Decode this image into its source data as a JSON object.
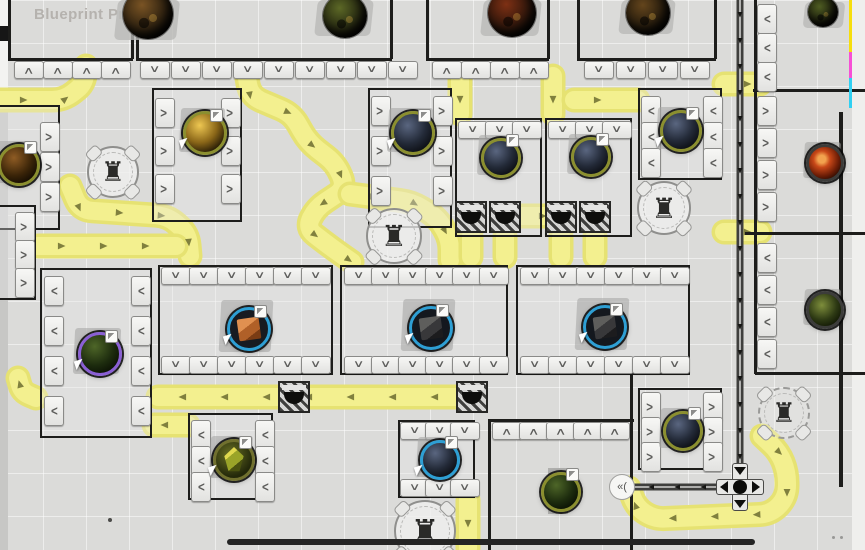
{
  "header": {
    "title": "Blueprint Preview"
  },
  "colors": {
    "background": "#dbdbd9",
    "belt": "#f3f08f",
    "belt_edge": "#e6e272",
    "belt_arrow": "#80803e",
    "wall": "#1d1d1b",
    "rail": "#3f3f3d",
    "module_fill": "#f1f1ef",
    "accent_blue": "#2e9fd4",
    "accent_olive": "#8b8f2f",
    "strip_yellow": "#f6de0c",
    "strip_magenta": "#f750d6",
    "strip_cyan": "#30d0f2",
    "title_text": "#b5b2ae"
  },
  "scene": {
    "belts": [
      {
        "points": [
          [
            0,
            100
          ],
          [
            64,
            100
          ],
          [
            84,
            84
          ],
          [
            86,
            66
          ]
        ]
      },
      {
        "points": [
          [
            246,
            72
          ],
          [
            250,
            96
          ],
          [
            292,
            114
          ],
          [
            308,
            142
          ],
          [
            336,
            164
          ],
          [
            346,
            188
          ],
          [
            316,
            208
          ],
          [
            306,
            228
          ],
          [
            332,
            248
          ],
          [
            352,
            262
          ]
        ]
      },
      {
        "points": [
          [
            350,
            194
          ],
          [
            412,
            202
          ],
          [
            438,
            218
          ],
          [
            450,
            240
          ],
          [
            450,
            260
          ]
        ]
      },
      {
        "points": [
          [
            70,
            186
          ],
          [
            80,
            210
          ],
          [
            168,
            216
          ],
          [
            188,
            234
          ],
          [
            190,
            256
          ]
        ]
      },
      {
        "points": [
          [
            38,
            246
          ],
          [
            176,
            246
          ]
        ]
      },
      {
        "points": [
          [
            460,
            76
          ],
          [
            460,
            114
          ]
        ]
      },
      {
        "points": [
          [
            553,
            76
          ],
          [
            553,
            114
          ]
        ]
      },
      {
        "points": [
          [
            574,
            100
          ],
          [
            638,
            100
          ]
        ]
      },
      {
        "points": [
          [
            519,
            216
          ],
          [
            547,
            216
          ]
        ]
      },
      {
        "points": [
          [
            471,
            236
          ],
          [
            471,
            257
          ]
        ]
      },
      {
        "points": [
          [
            505,
            236
          ],
          [
            505,
            257
          ]
        ]
      },
      {
        "points": [
          [
            561,
            236
          ],
          [
            561,
            257
          ]
        ]
      },
      {
        "points": [
          [
            595,
            236
          ],
          [
            595,
            257
          ]
        ]
      },
      {
        "points": [
          [
            724,
            84
          ],
          [
            760,
            84
          ]
        ]
      },
      {
        "points": [
          [
            724,
            232
          ],
          [
            760,
            232
          ]
        ]
      },
      {
        "points": [
          [
            458,
            397
          ],
          [
            158,
            397
          ]
        ]
      },
      {
        "points": [
          [
            36,
            398
          ],
          [
            22,
            392
          ],
          [
            18,
            378
          ]
        ]
      },
      {
        "points": [
          [
            188,
            425
          ],
          [
            154,
            425
          ]
        ]
      },
      {
        "points": [
          [
            468,
            500
          ],
          [
            468,
            548
          ]
        ]
      },
      {
        "points": [
          [
            762,
            436
          ],
          [
            779,
            452
          ],
          [
            787,
            472
          ],
          [
            787,
            497
          ],
          [
            771,
            514
          ],
          [
            654,
            519
          ],
          [
            636,
            507
          ],
          [
            629,
            488
          ]
        ]
      }
    ],
    "rails": [
      {
        "points": [
          [
            740,
            0
          ],
          [
            740,
            464
          ]
        ]
      },
      {
        "points": [
          [
            718,
            487
          ],
          [
            634,
            487
          ]
        ]
      }
    ],
    "walls": [
      [
        8,
        0,
        2.5,
        59
      ],
      [
        131,
        0,
        2.5,
        59
      ],
      [
        136,
        0,
        2.5,
        59
      ],
      [
        390,
        0,
        2.5,
        59
      ],
      [
        426,
        0,
        2.5,
        59
      ],
      [
        547,
        0,
        2.5,
        59
      ],
      [
        577,
        0,
        2.5,
        59
      ],
      [
        714,
        0,
        2.5,
        59
      ],
      [
        8,
        58,
        125,
        2.5
      ],
      [
        136,
        58,
        256,
        2.5
      ],
      [
        426,
        58,
        123,
        2.5
      ],
      [
        577,
        58,
        139,
        2.5
      ],
      [
        754,
        0,
        2.5,
        374
      ],
      [
        753,
        89,
        112,
        2.5
      ],
      [
        745,
        232,
        120,
        2.5
      ],
      [
        755,
        372,
        110,
        2.5
      ],
      [
        839,
        112,
        4,
        375
      ],
      [
        630,
        373,
        2.5,
        177
      ],
      [
        488,
        419,
        146,
        2.5
      ],
      [
        488,
        421,
        2.5,
        129
      ]
    ],
    "platforms": [
      [
        152,
        88,
        90,
        134
      ],
      [
        368,
        88,
        84,
        140
      ],
      [
        455,
        118,
        87,
        119
      ],
      [
        545,
        118,
        87,
        119
      ],
      [
        638,
        88,
        84,
        92
      ],
      [
        158,
        265,
        175,
        110
      ],
      [
        340,
        265,
        168,
        110
      ],
      [
        516,
        265,
        174,
        110
      ],
      [
        40,
        268,
        112,
        170
      ],
      [
        188,
        413,
        85,
        87
      ],
      [
        398,
        420,
        77,
        78
      ],
      [
        638,
        388,
        84,
        82
      ],
      [
        -30,
        105,
        90,
        125
      ],
      [
        -20,
        205,
        56,
        95
      ]
    ],
    "port_groups": [
      {
        "x": 14,
        "y": 61,
        "axis": "h",
        "n": 4,
        "dir": "up",
        "step": 29
      },
      {
        "x": 140,
        "y": 61,
        "axis": "h",
        "n": 9,
        "dir": "down",
        "step": 31
      },
      {
        "x": 432,
        "y": 61,
        "axis": "h",
        "n": 4,
        "dir": "up",
        "step": 29
      },
      {
        "x": 584,
        "y": 61,
        "axis": "h",
        "n": 4,
        "dir": "down",
        "step": 32
      },
      {
        "x": 757,
        "y": 4,
        "axis": "v",
        "n": 3,
        "dir": "left",
        "step": 29
      },
      {
        "x": 757,
        "y": 96,
        "axis": "v",
        "n": 4,
        "dir": "right",
        "step": 32
      },
      {
        "x": 757,
        "y": 243,
        "axis": "v",
        "n": 4,
        "dir": "left",
        "step": 32
      },
      {
        "x": 155,
        "y": 98,
        "axis": "v",
        "n": 3,
        "dir": "right",
        "step": 38
      },
      {
        "x": 221,
        "y": 98,
        "axis": "v",
        "n": 3,
        "dir": "right",
        "step": 38
      },
      {
        "x": 371,
        "y": 96,
        "axis": "v",
        "n": 3,
        "dir": "right",
        "step": 40
      },
      {
        "x": 433,
        "y": 96,
        "axis": "v",
        "n": 3,
        "dir": "right",
        "step": 40
      },
      {
        "x": 458,
        "y": 121,
        "axis": "h",
        "n": 3,
        "dir": "down",
        "step": 27
      },
      {
        "x": 548,
        "y": 121,
        "axis": "h",
        "n": 3,
        "dir": "down",
        "step": 27
      },
      {
        "x": 641,
        "y": 96,
        "axis": "v",
        "n": 3,
        "dir": "left",
        "step": 26
      },
      {
        "x": 703,
        "y": 96,
        "axis": "v",
        "n": 3,
        "dir": "left",
        "step": 26
      },
      {
        "x": 40,
        "y": 122,
        "axis": "v",
        "n": 3,
        "dir": "right",
        "step": 30
      },
      {
        "x": 15,
        "y": 212,
        "axis": "v",
        "n": 3,
        "dir": "right",
        "step": 28
      },
      {
        "x": 44,
        "y": 276,
        "axis": "v",
        "n": 4,
        "dir": "left",
        "step": 40
      },
      {
        "x": 131,
        "y": 276,
        "axis": "v",
        "n": 4,
        "dir": "left",
        "step": 40
      },
      {
        "x": 161,
        "y": 267,
        "axis": "h",
        "n": 6,
        "dir": "down",
        "step": 28
      },
      {
        "x": 161,
        "y": 356,
        "axis": "h",
        "n": 6,
        "dir": "down",
        "step": 28
      },
      {
        "x": 344,
        "y": 267,
        "axis": "h",
        "n": 6,
        "dir": "down",
        "step": 27
      },
      {
        "x": 344,
        "y": 356,
        "axis": "h",
        "n": 6,
        "dir": "down",
        "step": 27
      },
      {
        "x": 520,
        "y": 267,
        "axis": "h",
        "n": 6,
        "dir": "down",
        "step": 28
      },
      {
        "x": 520,
        "y": 356,
        "axis": "h",
        "n": 6,
        "dir": "down",
        "step": 28
      },
      {
        "x": 191,
        "y": 420,
        "axis": "v",
        "n": 3,
        "dir": "left",
        "step": 26
      },
      {
        "x": 255,
        "y": 420,
        "axis": "v",
        "n": 3,
        "dir": "left",
        "step": 26
      },
      {
        "x": 400,
        "y": 422,
        "axis": "h",
        "n": 3,
        "dir": "down",
        "step": 25
      },
      {
        "x": 400,
        "y": 479,
        "axis": "h",
        "n": 3,
        "dir": "down",
        "step": 25
      },
      {
        "x": 492,
        "y": 422,
        "axis": "h",
        "n": 5,
        "dir": "up",
        "step": 27
      },
      {
        "x": 641,
        "y": 392,
        "axis": "v",
        "n": 3,
        "dir": "right",
        "step": 25
      },
      {
        "x": 703,
        "y": 392,
        "axis": "v",
        "n": 3,
        "dir": "right",
        "step": 25
      }
    ],
    "tunnels": [
      [
        455,
        201
      ],
      [
        489,
        201
      ],
      [
        545,
        201
      ],
      [
        579,
        201
      ],
      [
        278,
        381
      ],
      [
        456,
        381
      ]
    ],
    "towers": [
      {
        "x": 113,
        "y": 172,
        "r": 26,
        "icon": "♜"
      },
      {
        "x": 394,
        "y": 236,
        "r": 28,
        "icon": "♜"
      },
      {
        "x": 664,
        "y": 208,
        "r": 27,
        "icon": "♜"
      },
      {
        "x": 425,
        "y": 531,
        "r": 31,
        "icon": "♜"
      },
      {
        "x": 784,
        "y": 413,
        "r": 26,
        "icon": "♜",
        "dashed": true
      }
    ],
    "orbs": [
      {
        "x": 202,
        "y": 130,
        "r": 19,
        "ring": "#8b8f2f",
        "body": "amber",
        "kind": "sphere",
        "pad": 44,
        "badge": true,
        "cursor": true
      },
      {
        "x": 410,
        "y": 130,
        "r": 19,
        "ring": "#8b8f2f",
        "body": "navy",
        "kind": "sphere",
        "pad": 44,
        "badge": true,
        "cursor": true
      },
      {
        "x": 498,
        "y": 155,
        "r": 17,
        "ring": "#8b8f2f",
        "body": "navy",
        "kind": "sphere",
        "pad": 40,
        "badge": true,
        "cursor": false
      },
      {
        "x": 588,
        "y": 154,
        "r": 17,
        "ring": "#8b8f2f",
        "body": "navy",
        "kind": "sphere",
        "pad": 40,
        "badge": true,
        "cursor": false
      },
      {
        "x": 678,
        "y": 128,
        "r": 18,
        "ring": "#8b8f2f",
        "body": "navy",
        "kind": "sphere",
        "pad": 42,
        "badge": true,
        "cursor": true
      },
      {
        "x": 16,
        "y": 162,
        "r": 18,
        "ring": "#8b8f2f",
        "body": "brown",
        "kind": "sphere",
        "pad": 42,
        "badge": true,
        "cursor": false
      },
      {
        "x": 97,
        "y": 351,
        "r": 19,
        "ring": "#8a5fd4",
        "body": "green_dark",
        "kind": "sphere",
        "pad": 46,
        "badge": true,
        "cursor": true
      },
      {
        "x": 246,
        "y": 326,
        "r": 19,
        "ring": "#2e9fd4",
        "body": "orange_cube",
        "kind": "cube",
        "pad": 52,
        "badge": true,
        "cursor": true
      },
      {
        "x": 428,
        "y": 325,
        "r": 19,
        "ring": "#2e9fd4",
        "body": "dark_cube",
        "kind": "cube",
        "pad": 52,
        "badge": true,
        "cursor": true
      },
      {
        "x": 602,
        "y": 324,
        "r": 19,
        "ring": "#2e9fd4",
        "body": "dark_cube",
        "kind": "cube",
        "pad": 52,
        "badge": true,
        "cursor": true
      },
      {
        "x": 437,
        "y": 457,
        "r": 17,
        "ring": "#2e9fd4",
        "body": "navy",
        "kind": "sphere",
        "pad": 40,
        "badge": true,
        "cursor": true
      },
      {
        "x": 231,
        "y": 457,
        "r": 18,
        "ring": "#70702e",
        "body": "crystal",
        "kind": "crystal",
        "pad": 42,
        "badge": true,
        "cursor": true
      },
      {
        "x": 558,
        "y": 489,
        "r": 17,
        "ring": "#8b8f2f",
        "body": "green_dark",
        "kind": "sphere",
        "pad": 0,
        "badge": true,
        "cursor": false
      },
      {
        "x": 680,
        "y": 428,
        "r": 17,
        "ring": "#8b8f2f",
        "body": "navy",
        "kind": "sphere",
        "pad": 40,
        "badge": true,
        "cursor": false
      },
      {
        "x": 822,
        "y": 160,
        "r": 16,
        "ring": "#3c3c3a",
        "body": "red",
        "kind": "sphere",
        "pad": 36,
        "badge": false,
        "cursor": false
      },
      {
        "x": 822,
        "y": 307,
        "r": 16,
        "ring": "#3c3c3a",
        "body": "green_mottled",
        "kind": "sphere",
        "pad": 36,
        "badge": false,
        "cursor": false
      }
    ],
    "mini_pads": [
      [
        548,
        468,
        20,
        8
      ],
      [
        548,
        506,
        20,
        8
      ]
    ],
    "asteroid_pads": [
      [
        116,
        0,
        62,
        40
      ],
      [
        316,
        0,
        56,
        36
      ],
      [
        482,
        0,
        58,
        36
      ],
      [
        620,
        0,
        54,
        34
      ],
      [
        804,
        2,
        40,
        26
      ]
    ],
    "asteroids": [
      {
        "x": 148,
        "y": 14,
        "r": 25,
        "tint": "#7a5424"
      },
      {
        "x": 345,
        "y": 16,
        "r": 22,
        "tint": "#5c6826"
      },
      {
        "x": 512,
        "y": 13,
        "r": 24,
        "tint": "#7e3014"
      },
      {
        "x": 648,
        "y": 13,
        "r": 22,
        "tint": "#64451c"
      },
      {
        "x": 823,
        "y": 12,
        "r": 15,
        "tint": "#4e5c22"
      }
    ],
    "extras": {
      "left_strip": [
        [
          0,
          0,
          8,
          92,
          "#f3f3f1"
        ],
        [
          0,
          92,
          8,
          458,
          "#c7c7c5"
        ]
      ],
      "notch": [
        0,
        26,
        8,
        15,
        "#161616"
      ],
      "right_column": [
        852,
        0,
        13,
        550,
        "#efefed"
      ],
      "color_strips": [
        [
          849,
          0,
          3,
          52,
          "#f6de0c"
        ],
        [
          849,
          52,
          3,
          26,
          "#f750d6"
        ],
        [
          849,
          78,
          3,
          30,
          "#30d0f2"
        ]
      ],
      "bottom_bar": [
        227,
        539,
        528,
        6,
        "#242424"
      ],
      "dots": [
        [
          108,
          518,
          4,
          "#4a4a48"
        ],
        [
          832,
          536,
          3,
          "#989896"
        ],
        [
          840,
          536,
          3,
          "#989896"
        ]
      ],
      "rail_cross": {
        "x": 740,
        "y": 487,
        "size": 48
      },
      "dock_icon": {
        "x": 622,
        "y": 487,
        "r": 13,
        "label": "«("
      }
    }
  }
}
